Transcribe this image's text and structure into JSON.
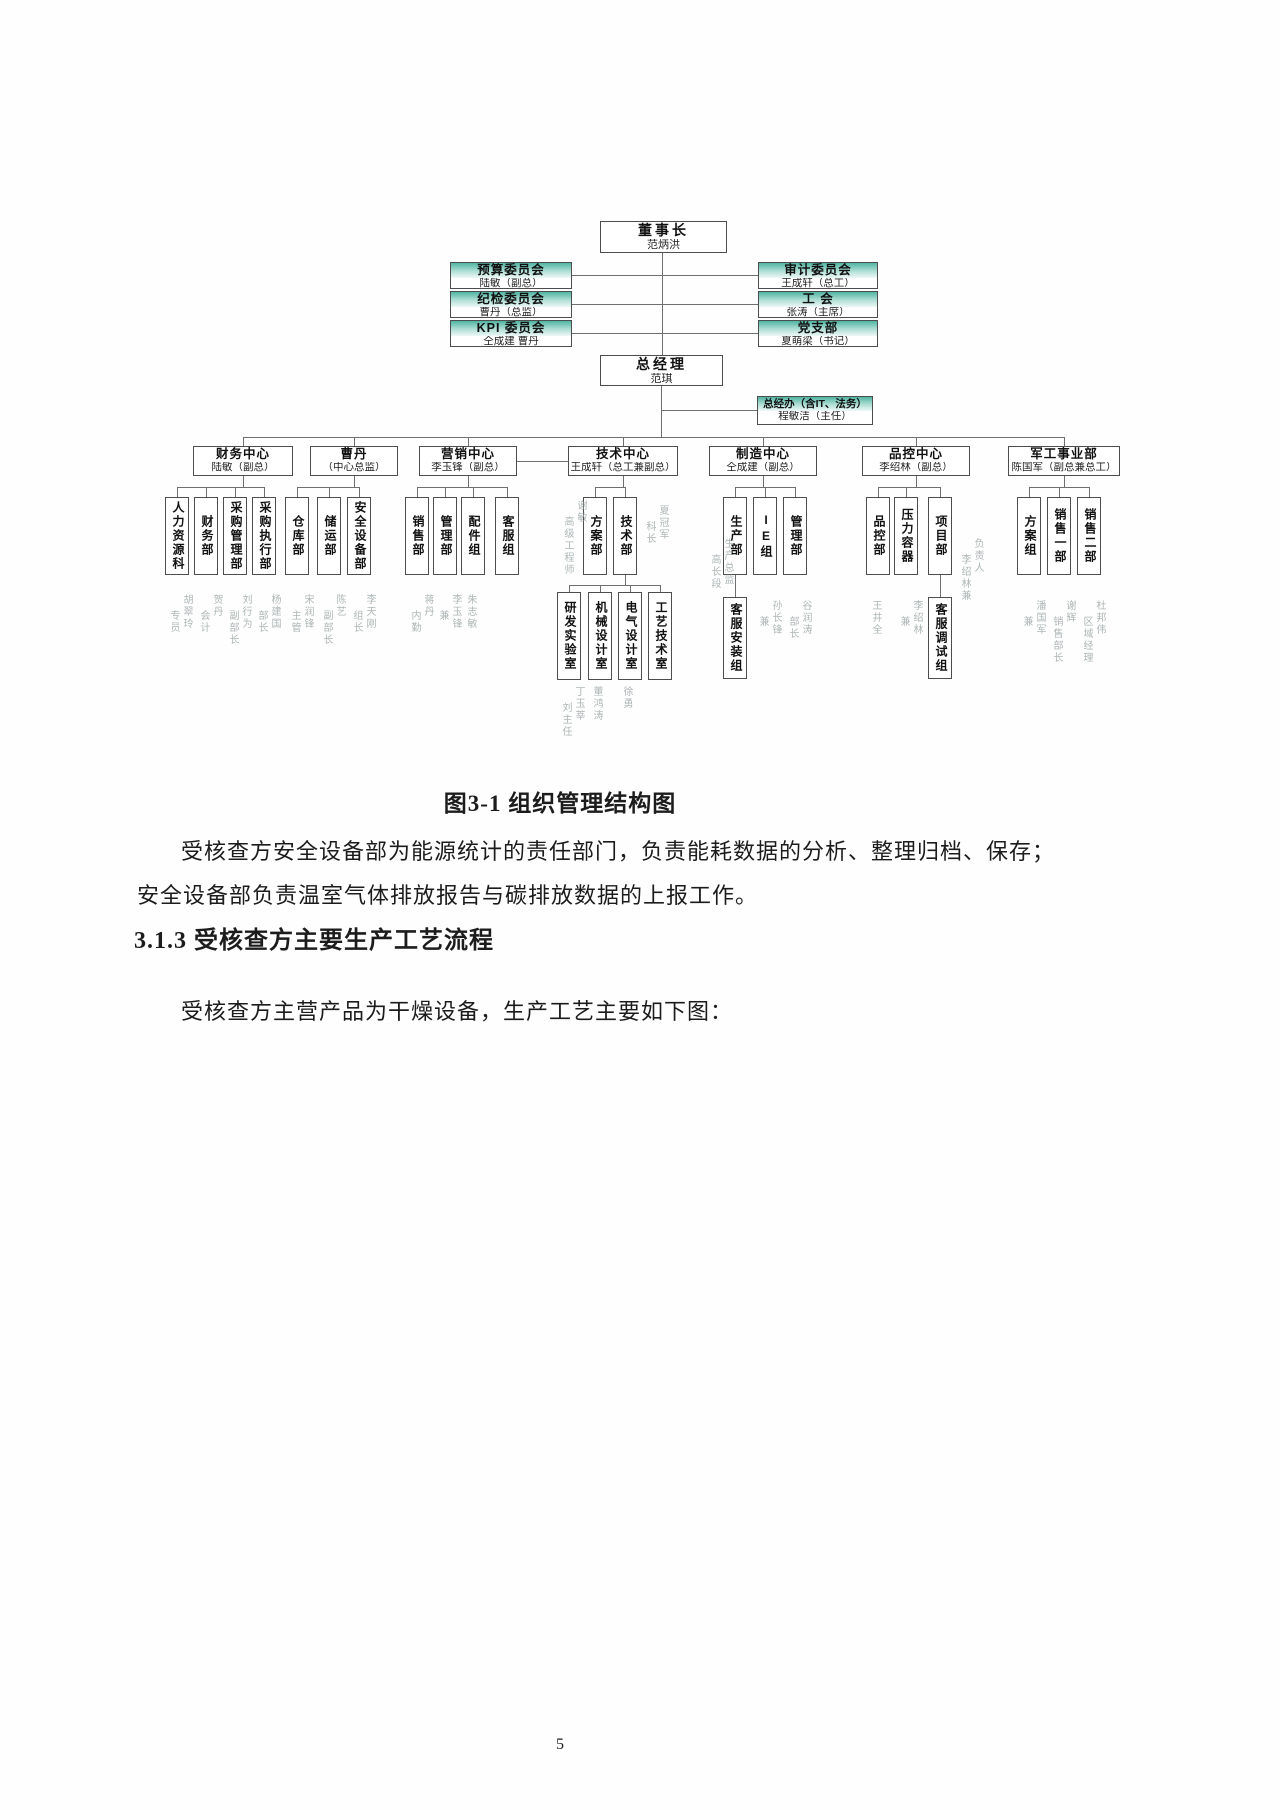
{
  "colors": {
    "committee_header_teal": "#4fb4a2",
    "connector_line": "#6f6f6f"
  },
  "page": {
    "number": "5"
  },
  "document": {
    "figure_caption": "图3-1 组织管理结构图",
    "para1_line1": "受核查方安全设备部为能源统计的责任部门，负责能耗数据的分析、整理归档、保存；",
    "para1_line2": "安全设备部负责温室气体排放报告与碳排放数据的上报工作。",
    "section_heading": "3.1.3 受核查方主要生产工艺流程",
    "para2": "受核查方主营产品为干燥设备，生产工艺主要如下图："
  },
  "org": {
    "chairman": {
      "title": "董事长",
      "name": "范炳洪"
    },
    "gm": {
      "title": "总经理",
      "name": "范琪"
    },
    "gm_office": {
      "title": "总经办（含IT、法务）",
      "name": "程敏洁（主任）"
    },
    "committees_left": [
      {
        "title": "预算委员会",
        "name": "陆敏（副总）"
      },
      {
        "title": "纪检委员会",
        "name": "曹丹（总监）"
      },
      {
        "title": "KPI 委员会",
        "name": "仝成建 曹丹"
      }
    ],
    "committees_right": [
      {
        "title": "审计委员会",
        "name": "王成轩（总工）"
      },
      {
        "title": "工  会",
        "name": "张涛（主席）"
      },
      {
        "title": "党支部",
        "name": "夏萌梁（书记）"
      }
    ],
    "centers": [
      {
        "title": "财务中心",
        "name": "陆敏（副总）"
      },
      {
        "title": "曹丹",
        "name": "（中心总监）"
      },
      {
        "title": "营销中心",
        "name": "李玉锋（副总）"
      },
      {
        "title": "技术中心",
        "name": "王成轩（总工兼副总）"
      },
      {
        "title": "制造中心",
        "name": "仝成建（副总）"
      },
      {
        "title": "品控中心",
        "name": "李绍林（副总）"
      },
      {
        "title": "军工事业部",
        "name": "陈国军（副总兼总工）"
      }
    ],
    "depts": [
      "人力资源科",
      "财务部",
      "采购管理部",
      "采购执行部",
      "仓库部",
      "储运部",
      "安全设备部",
      "销售部",
      "管理部",
      "配件组",
      "客服组",
      "方案部",
      "技术部",
      "生产部",
      "IE组",
      "管理部",
      "品控部",
      "压力容器",
      "项目部",
      "方案组",
      "销售一部",
      "销售二部"
    ],
    "subs": [
      "研发实验室",
      "机械设计室",
      "电气设计室",
      "工艺技术室",
      "客服安装组",
      "客服调试组"
    ],
    "notes": [
      {
        "c1": "胡翠玲",
        "c2": "专员"
      },
      {
        "c1": "贺丹",
        "c2": "会计"
      },
      {
        "c1": "刘行为",
        "c2": "副部长"
      },
      {
        "c1": "杨建国",
        "c2": "部长"
      },
      {
        "c1": "宋润锋",
        "c2": "主管"
      },
      {
        "c1": "陈艺",
        "c2": "副部长"
      },
      {
        "c1": "李天刚",
        "c2": "组长"
      },
      {
        "c1": "蒋丹",
        "c2": "内勤"
      },
      {
        "c1": "李玉锋",
        "c2": "兼"
      },
      {
        "c1": "朱志敏",
        "c2": ""
      },
      {
        "c1": "谢敏",
        "c2": "高级工程师"
      },
      {
        "c1": "夏冠军",
        "c2": "科长"
      },
      {
        "c1": "丁玉莘",
        "c2": "刘主任"
      },
      {
        "c1": "董鸿涛",
        "c2": ""
      },
      {
        "c1": "徐勇",
        "c2": ""
      },
      {
        "c1": "生产总监",
        "c2": "高长段"
      },
      {
        "c1": "孙长锋",
        "c2": "兼"
      },
      {
        "c1": "谷润涛",
        "c2": "部长"
      },
      {
        "c1": "王井全",
        "c2": ""
      },
      {
        "c1": "李绍林",
        "c2": "兼"
      },
      {
        "c1": "负责人",
        "c2": "李绍林兼"
      },
      {
        "c1": "潘国军",
        "c2": "兼"
      },
      {
        "c1": "谢辉",
        "c2": "销售部长"
      },
      {
        "c1": "杜邦伟",
        "c2": "区域经理"
      }
    ]
  }
}
